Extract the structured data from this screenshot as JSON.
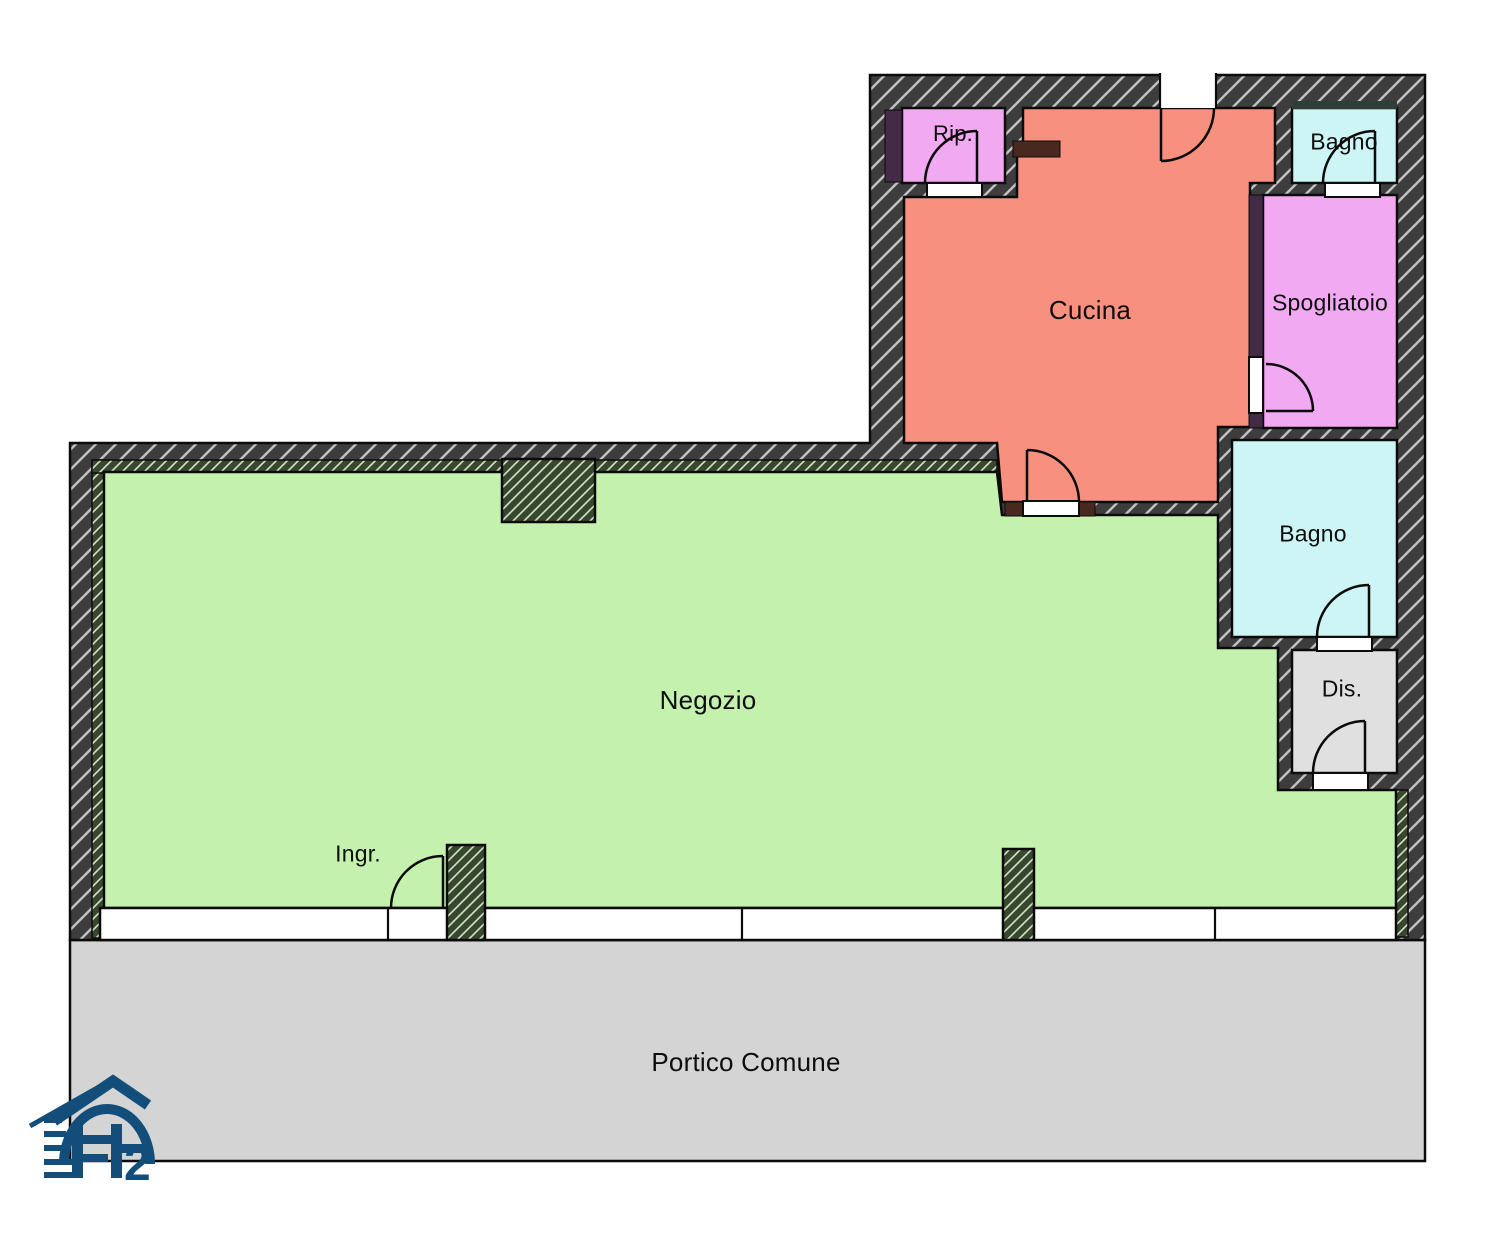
{
  "plan": {
    "rooms": {
      "rip": {
        "label": "Rip.",
        "color": "#F1A9F1"
      },
      "bagno_top": {
        "label": "Bagno",
        "color": "#CDF5F5"
      },
      "cucina": {
        "label": "Cucina",
        "color": "#F8907F"
      },
      "spogliatoio": {
        "label": "Spogliatoio",
        "color": "#F1A9F1"
      },
      "bagno_right": {
        "label": "Bagno",
        "color": "#CDF5F5"
      },
      "dis": {
        "label": "Dis.",
        "color": "#E0E0E0"
      },
      "negozio": {
        "label": "Negozio",
        "color": "#C5F1AF"
      },
      "portico": {
        "label": "Portico Comune",
        "color": "#D4D4D4"
      }
    },
    "entrance": {
      "label": "Ingr."
    },
    "colors": {
      "wall_fill": "#3D3D3D",
      "wall_hatch": "#C2C2C2",
      "wall2_fill": "#3A4730",
      "wall2_hatch": "#D3E4C6",
      "accent_purple": "#432A45",
      "accent_brown": "#49291F",
      "teal_band": "#2F3E38",
      "sill": "#FFFFFF",
      "line": "#0B0B0B",
      "logo_blue": "#134E7B"
    },
    "logo": {
      "text": "FP2",
      "digit": "2"
    }
  }
}
